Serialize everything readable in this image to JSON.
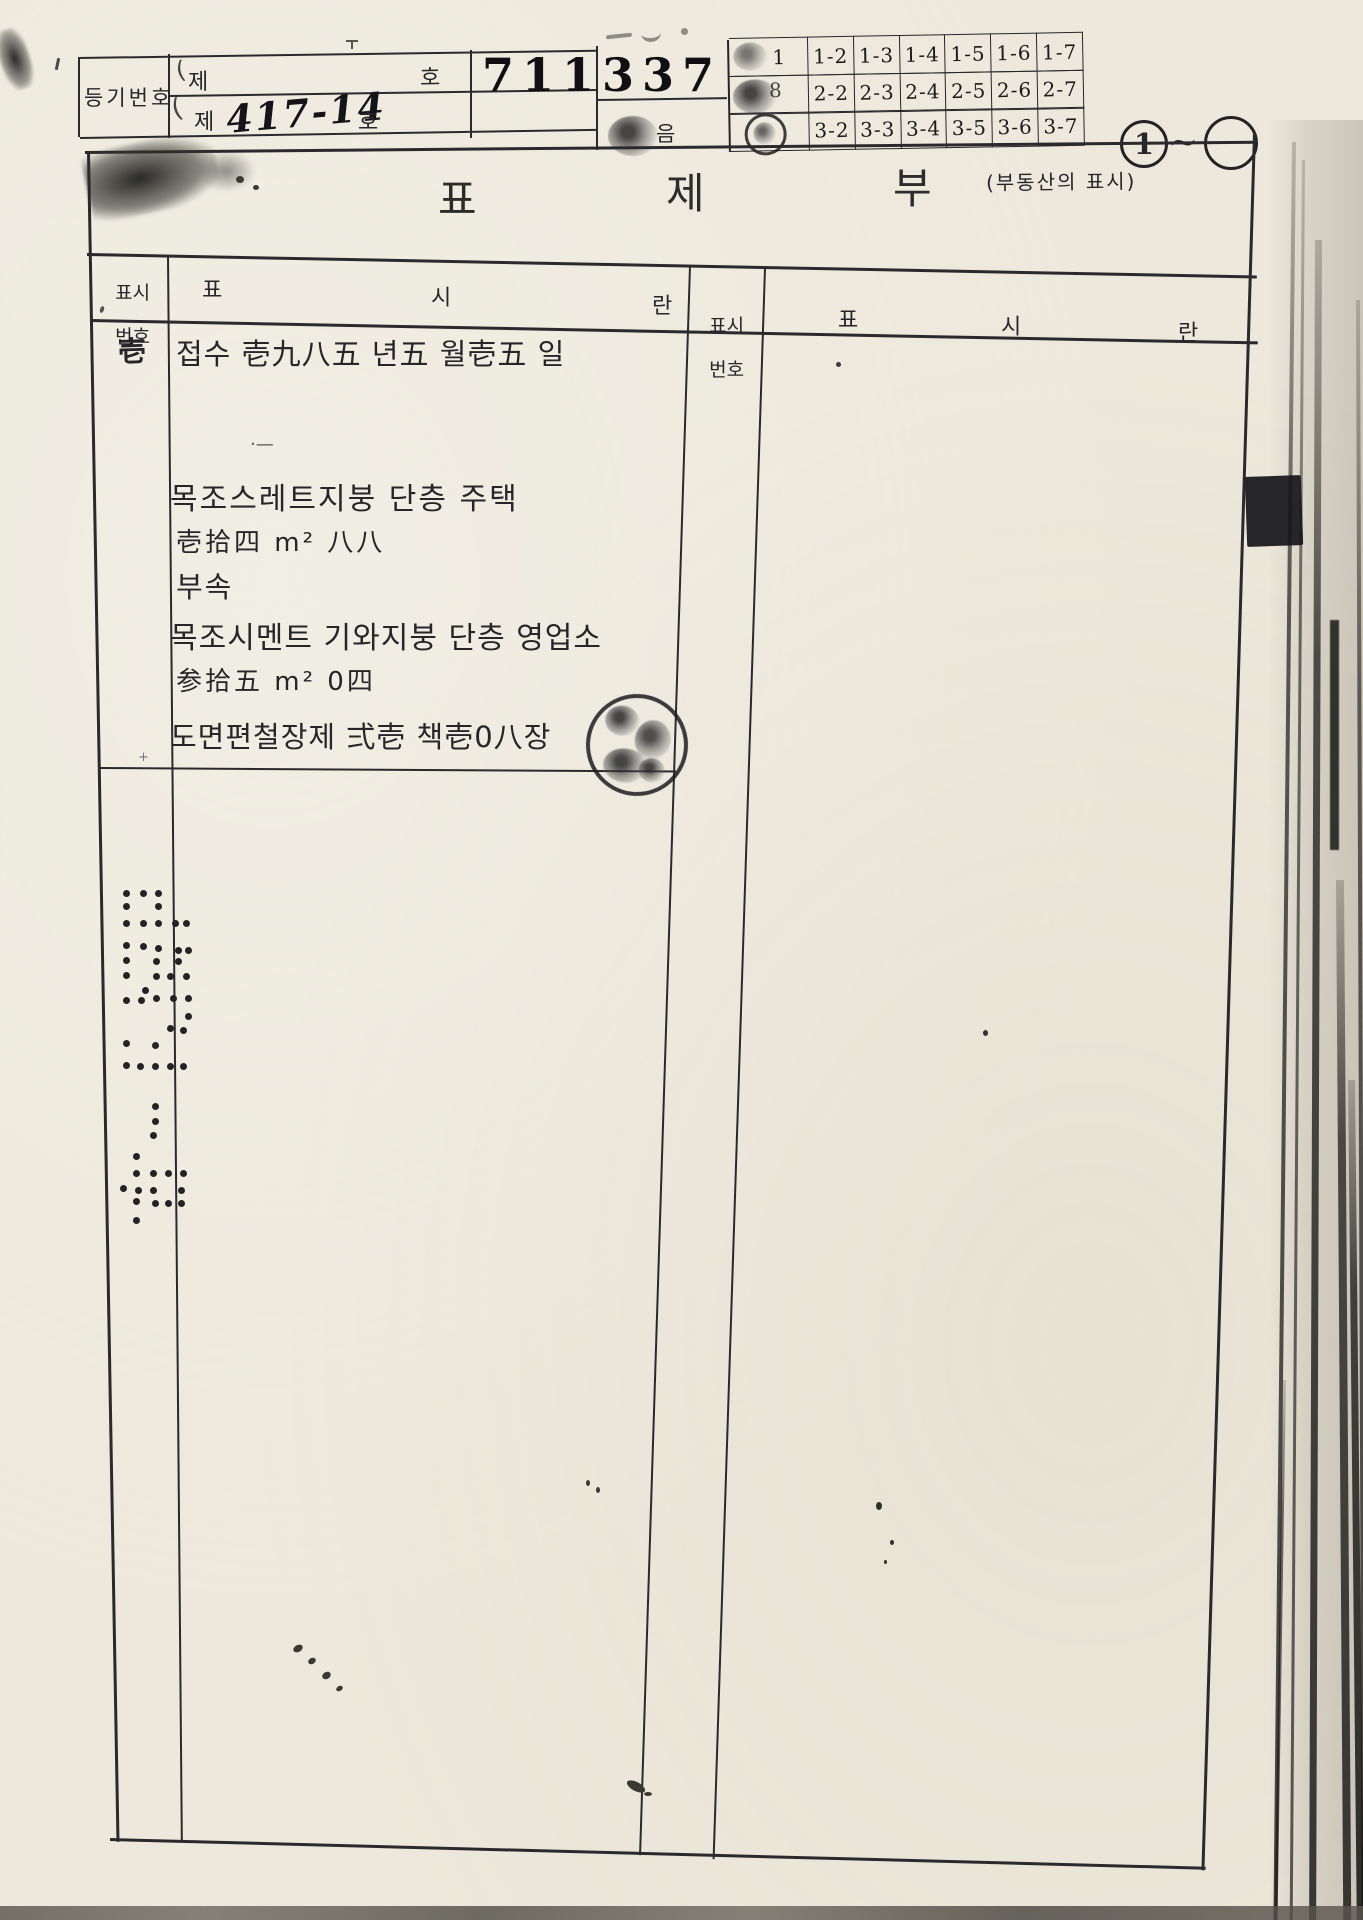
{
  "header": {
    "registration_label": "등기번호",
    "row1_prefix": "제",
    "row1_suffix": "호",
    "row2_prefix": "제",
    "row2_number": "417-14",
    "row2_suffix": "호",
    "serial_number": "711337",
    "eup_note": "음",
    "grid": {
      "row1_first": "1",
      "row2_first": "8",
      "row1": [
        "1-2",
        "1-3",
        "1-4",
        "1-5",
        "1-6",
        "1-7"
      ],
      "row2": [
        "2-2",
        "2-3",
        "2-4",
        "2-5",
        "2-6",
        "2-7"
      ],
      "row3": [
        "3-2",
        "3-3",
        "3-4",
        "3-5",
        "3-6",
        "3-7"
      ]
    },
    "page_circle_start": "1",
    "page_circle_tilde": "~"
  },
  "title": {
    "char1": "표",
    "char2": "제",
    "char3": "부",
    "subtitle": "(부동산의 표시)"
  },
  "table": {
    "header_no_line1": "표시",
    "header_no_line2": "번호",
    "header_col1": "표",
    "header_col2": "시",
    "header_col3": "란",
    "entry": {
      "no": "壱",
      "receipt_line": "접수 壱九八五 년五 월壱五 일",
      "dash_mark": "·—",
      "building_line": "목조스레트지붕  단층  주택",
      "area1": "壱拾四 m² 八八",
      "annex_label": "부속",
      "annex_line": "목조시멘트 기와지붕  단층  영업소",
      "area2": "参拾五 m² 0四",
      "drawing_line": "도면편철장제 弍壱 책壱0八장"
    }
  }
}
